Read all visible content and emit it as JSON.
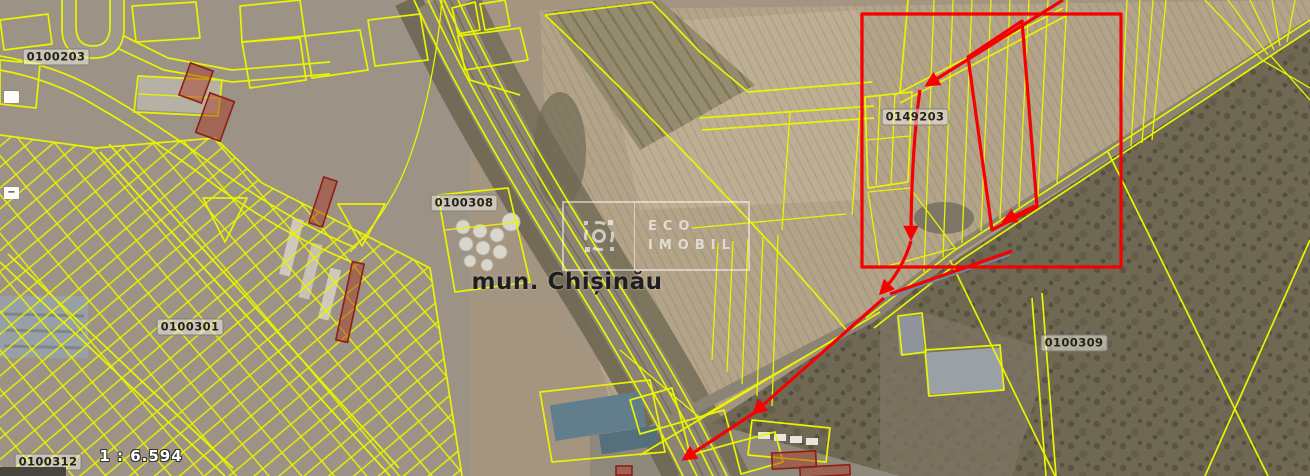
{
  "map": {
    "municipality_label": "mun. Chișinău",
    "scale_label": "1 : 6.594",
    "watermark": {
      "line1": "ECO",
      "line2": "IMOBIL"
    },
    "parcel_labels": [
      {
        "code": "0100203",
        "x": 56,
        "y": 57
      },
      {
        "code": "0100308",
        "x": 464,
        "y": 203
      },
      {
        "code": "0149203",
        "x": 915,
        "y": 117
      },
      {
        "code": "0100301",
        "x": 190,
        "y": 327
      },
      {
        "code": "0100309",
        "x": 1074,
        "y": 343
      },
      {
        "code": "0100312",
        "x": 48,
        "y": 462
      }
    ],
    "edge_markers": [
      {
        "x": 4,
        "y": 91,
        "glyph": ""
      },
      {
        "x": 4,
        "y": 187,
        "glyph": "−"
      }
    ],
    "colors": {
      "cadastre_line": "#eaf400",
      "highlight": "#f60000",
      "restricted_parcel": "#8d2014"
    }
  }
}
